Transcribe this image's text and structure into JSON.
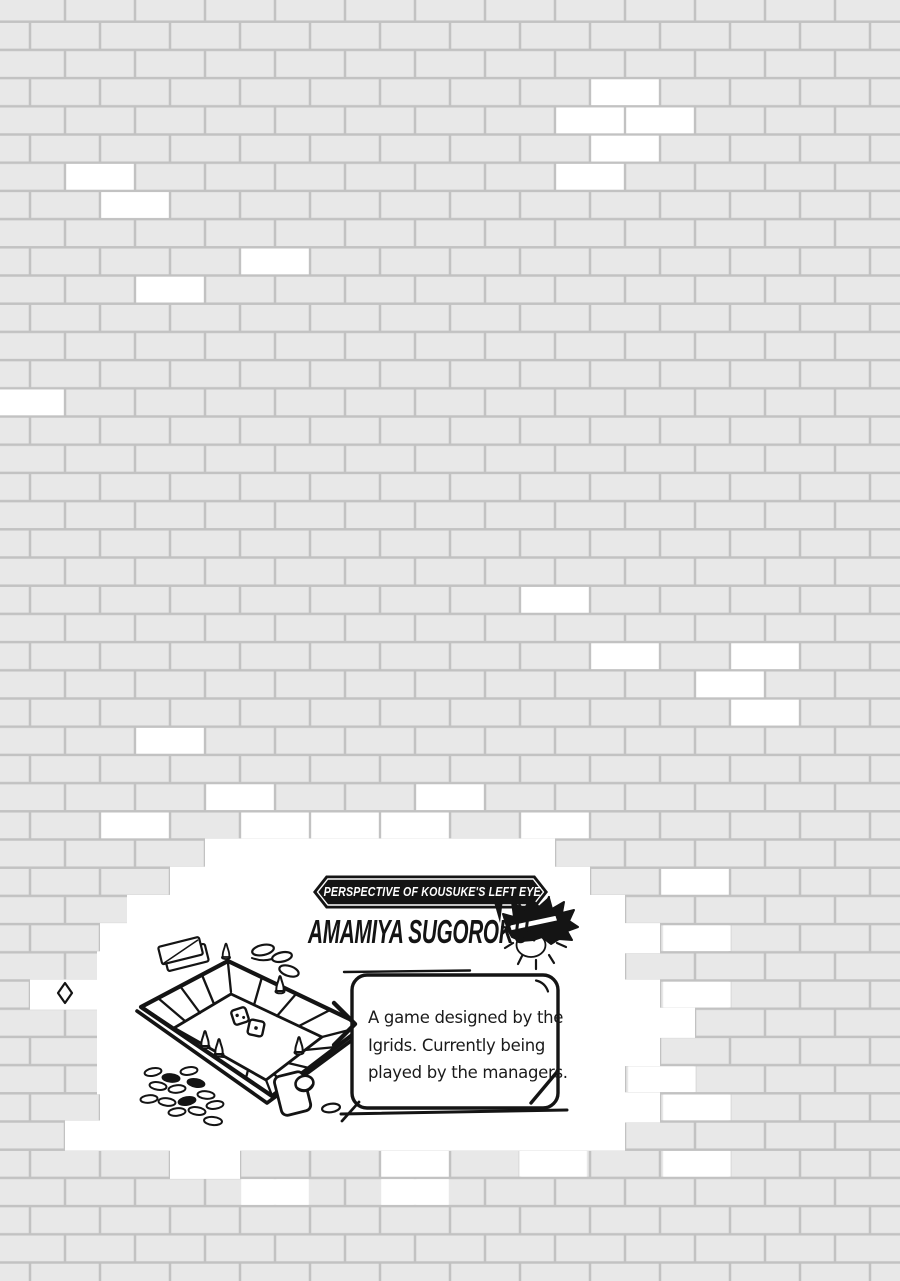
{
  "colors": {
    "brick": "#e8e8e8",
    "mortar": "#c2c2c2",
    "hole_white": "#ffffff",
    "ink": "#141414",
    "banner_fill": "#141414",
    "banner_text": "#ffffff"
  },
  "wall": {
    "brick_width": 70,
    "row_height": 28.2,
    "y_offset": -6.5,
    "mortar_thickness": 2.5,
    "white_bricks": [
      [
        3,
        590
      ],
      [
        4,
        555
      ],
      [
        4,
        625
      ],
      [
        5,
        590
      ],
      [
        6,
        555
      ],
      [
        6,
        65
      ],
      [
        7,
        100
      ],
      [
        9,
        240
      ],
      [
        10,
        135
      ],
      [
        14,
        -5
      ],
      [
        21,
        520
      ],
      [
        23,
        590
      ],
      [
        23,
        730
      ],
      [
        24,
        695
      ],
      [
        25,
        730
      ],
      [
        26,
        135
      ],
      [
        28,
        205
      ],
      [
        28,
        415
      ],
      [
        29,
        100
      ],
      [
        29,
        240
      ],
      [
        29,
        310
      ],
      [
        29,
        380
      ],
      [
        29,
        520
      ],
      [
        31,
        660
      ],
      [
        33,
        662
      ],
      [
        35,
        662
      ],
      [
        38,
        627
      ],
      [
        39,
        662
      ],
      [
        41,
        380
      ],
      [
        41,
        518
      ],
      [
        41,
        662
      ],
      [
        42,
        240
      ],
      [
        42,
        380
      ]
    ],
    "white_runs": [
      [
        30,
        205,
        555
      ],
      [
        31,
        170,
        590
      ],
      [
        32,
        127,
        625
      ],
      [
        33,
        100,
        660
      ],
      [
        34,
        97,
        625
      ],
      [
        35,
        30,
        660
      ],
      [
        36,
        97,
        695
      ],
      [
        37,
        97,
        660
      ],
      [
        38,
        97,
        625
      ],
      [
        39,
        100,
        660
      ],
      [
        40,
        65,
        625
      ],
      [
        41,
        170,
        240
      ]
    ]
  },
  "banner": {
    "label": "PERSPECTIVE OF KOUSUKE'S LEFT EYE"
  },
  "title": {
    "text": "AMAMIYA SUGOROKU"
  },
  "infobox": {
    "lines": [
      "A game designed by the",
      "Igrids. Currently being",
      "played by the managers."
    ]
  },
  "illustration": {
    "depicts": "Hand-drawn sugoroku board game with dice, pawns, coins, cards and a dice cup, plus a chibi face of Kousuke",
    "items": [
      "game-board",
      "dice",
      "pawns",
      "coin-pile",
      "coins",
      "playing-cards",
      "dice-cup",
      "character-face",
      "speech-bubble",
      "banner"
    ]
  }
}
